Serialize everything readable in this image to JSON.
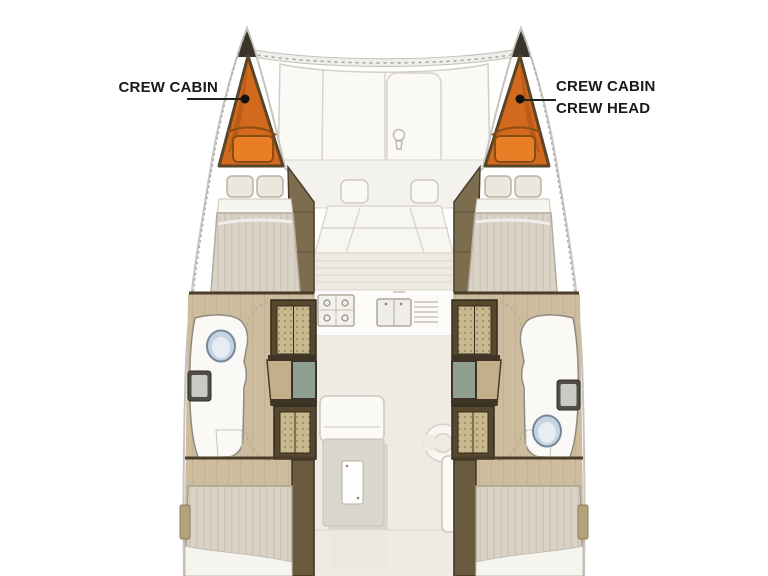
{
  "diagram": {
    "type": "catamaran-floor-plan",
    "labels": {
      "left_crew_cabin": "CREW CABIN",
      "right_crew_cabin": "CREW CABIN",
      "right_crew_head": "CREW HEAD"
    },
    "colors": {
      "crew_area_orange": "#D2691D",
      "crew_berth_orange": "#E87E26",
      "hull_outline": "#C6C4BF",
      "wood_floor": "#CDBC9E",
      "bulkhead_brown": "#4A3E2B",
      "hatch_glass_green": "#8E9E90",
      "toilet_blue": "#C6D4E2",
      "label_text": "#1A1A1A"
    }
  }
}
